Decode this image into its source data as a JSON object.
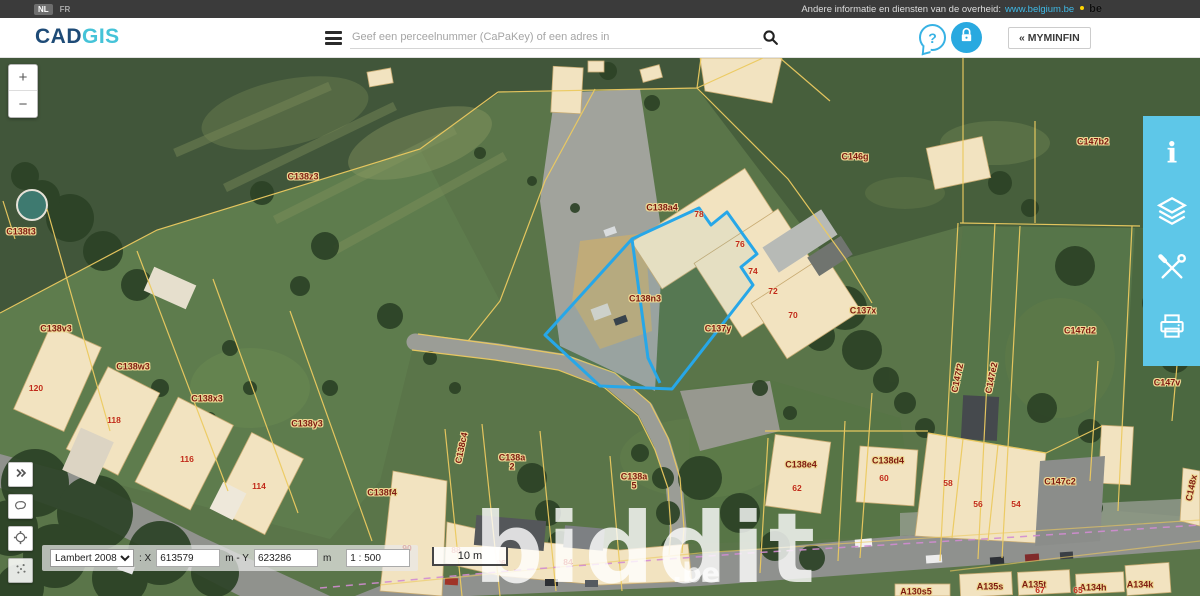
{
  "top_bar": {
    "lang_nl": "NL",
    "lang_fr": "FR",
    "gov_text": "Andere informatie en diensten van de overheid:",
    "gov_link": "www.belgium.be",
    "be_logo": "be"
  },
  "header": {
    "logo_cad": "CAD",
    "logo_gis": "GIS",
    "search_placeholder": "Geef een perceelnummer (CaPaKey) of een adres in",
    "search_value": "",
    "help_glyph": "?",
    "myminfin_label": "« MYMINFIN"
  },
  "right_toolbar": {
    "icons": [
      "info",
      "layers",
      "tools",
      "print"
    ]
  },
  "map_controls": {
    "zoom_in": "+",
    "zoom_out": "−",
    "projection": "Lambert 2008",
    "x_label": ": X",
    "x_value": "613579",
    "xy_sep": "m - Y",
    "y_value": "623286",
    "unit": "m",
    "scale_ratio": "1 : 500",
    "scale_bar": "10 m"
  },
  "watermark": {
    "main": "biddit",
    "suffix": ".be"
  },
  "map": {
    "colors": {
      "parcel_line": "#e9c75e",
      "highlight": "#27a7e8",
      "label": "#7e1a10",
      "house_number": "#c0281c",
      "toolbar": "#5ec7e8"
    },
    "parcel_labels": [
      {
        "t": "C138t3",
        "x": 21,
        "y": 174
      },
      {
        "t": "C138z3",
        "x": 303,
        "y": 119
      },
      {
        "t": "C146g",
        "x": 855,
        "y": 99
      },
      {
        "t": "C147b2",
        "x": 1093,
        "y": 84
      },
      {
        "t": "C138a4",
        "x": 662,
        "y": 150
      },
      {
        "t": "C138n3",
        "x": 645,
        "y": 241
      },
      {
        "t": "C137y",
        "x": 718,
        "y": 271
      },
      {
        "t": "C137x",
        "x": 863,
        "y": 253
      },
      {
        "t": "C147d2",
        "x": 1080,
        "y": 273
      },
      {
        "t": "C147v",
        "x": 1167,
        "y": 325
      },
      {
        "t": "C138v3",
        "x": 56,
        "y": 271
      },
      {
        "t": "C138w3",
        "x": 133,
        "y": 309
      },
      {
        "t": "C138x3",
        "x": 207,
        "y": 341
      },
      {
        "t": "C138y3",
        "x": 307,
        "y": 366
      },
      {
        "t": "C138f4",
        "x": 382,
        "y": 435
      },
      {
        "t": "C138e4",
        "x": 801,
        "y": 407
      },
      {
        "t": "C138d4",
        "x": 888,
        "y": 403
      },
      {
        "t": "C147c2",
        "x": 1060,
        "y": 424
      },
      {
        "t": "C138c4",
        "x": 462,
        "y": 390,
        "rot": -78
      },
      {
        "t": "C138a",
        "t2": "2",
        "x": 512,
        "y": 405
      },
      {
        "t": "C138a",
        "t2": "5",
        "x": 634,
        "y": 424
      },
      {
        "t": "C147f2",
        "x": 958,
        "y": 320,
        "rot": -78
      },
      {
        "t": "C147e2",
        "x": 992,
        "y": 320,
        "rot": -78
      },
      {
        "t": "C148x",
        "x": 1192,
        "y": 430,
        "rot": -78
      },
      {
        "t": "A130s5",
        "x": 916,
        "y": 534
      },
      {
        "t": "A135s",
        "x": 990,
        "y": 529
      },
      {
        "t": "A135t",
        "x": 1034,
        "y": 527
      },
      {
        "t": "A134h",
        "x": 1093,
        "y": 530
      },
      {
        "t": "A134k",
        "x": 1140,
        "y": 527
      }
    ],
    "house_numbers": [
      {
        "t": "78",
        "x": 699,
        "y": 156
      },
      {
        "t": "76",
        "x": 740,
        "y": 186
      },
      {
        "t": "74",
        "x": 753,
        "y": 213
      },
      {
        "t": "72",
        "x": 773,
        "y": 233
      },
      {
        "t": "70",
        "x": 793,
        "y": 257
      },
      {
        "t": "120",
        "x": 36,
        "y": 330
      },
      {
        "t": "118",
        "x": 114,
        "y": 362
      },
      {
        "t": "116",
        "x": 187,
        "y": 401
      },
      {
        "t": "114",
        "x": 259,
        "y": 428
      },
      {
        "t": "62",
        "x": 797,
        "y": 430
      },
      {
        "t": "60",
        "x": 884,
        "y": 420
      },
      {
        "t": "58",
        "x": 948,
        "y": 425
      },
      {
        "t": "56",
        "x": 978,
        "y": 446
      },
      {
        "t": "54",
        "x": 1016,
        "y": 446
      },
      {
        "t": "90",
        "x": 407,
        "y": 490
      },
      {
        "t": "88",
        "x": 456,
        "y": 492
      },
      {
        "t": "86",
        "x": 501,
        "y": 505
      },
      {
        "t": "84",
        "x": 568,
        "y": 504
      },
      {
        "t": "67",
        "x": 1040,
        "y": 532
      },
      {
        "t": "65",
        "x": 1078,
        "y": 532
      }
    ]
  }
}
